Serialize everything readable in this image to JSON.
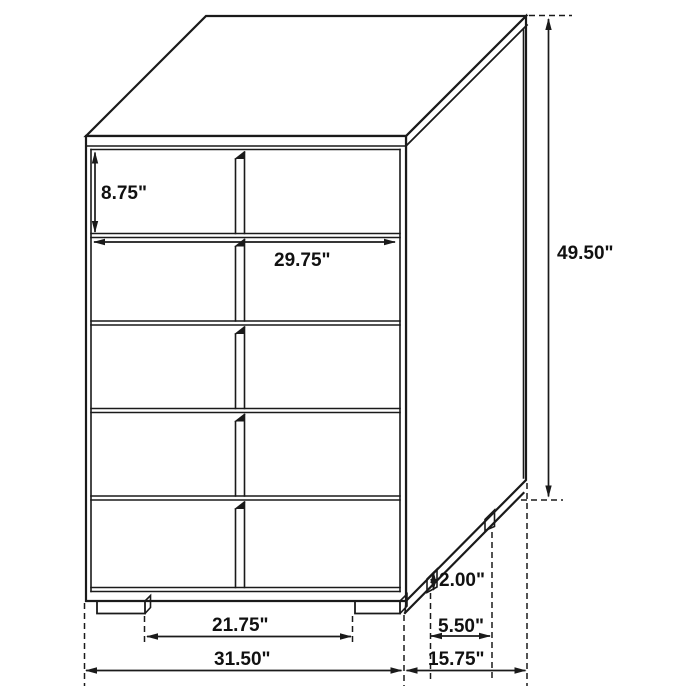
{
  "diagram": {
    "title": "5-drawer chest dimension line drawing",
    "unit": "inches",
    "dimensions": {
      "drawer_height": "8.75\"",
      "drawer_width": "29.75\"",
      "overall_height": "49.50\"",
      "leg_height": "2.00\"",
      "side_leg_spacing": "5.50\"",
      "front_leg_spacing": "21.75\"",
      "overall_width": "31.50\"",
      "overall_depth": "15.75\""
    },
    "colors": {
      "line": "#1a1a1a",
      "background": "#ffffff",
      "text": "#111111"
    }
  }
}
